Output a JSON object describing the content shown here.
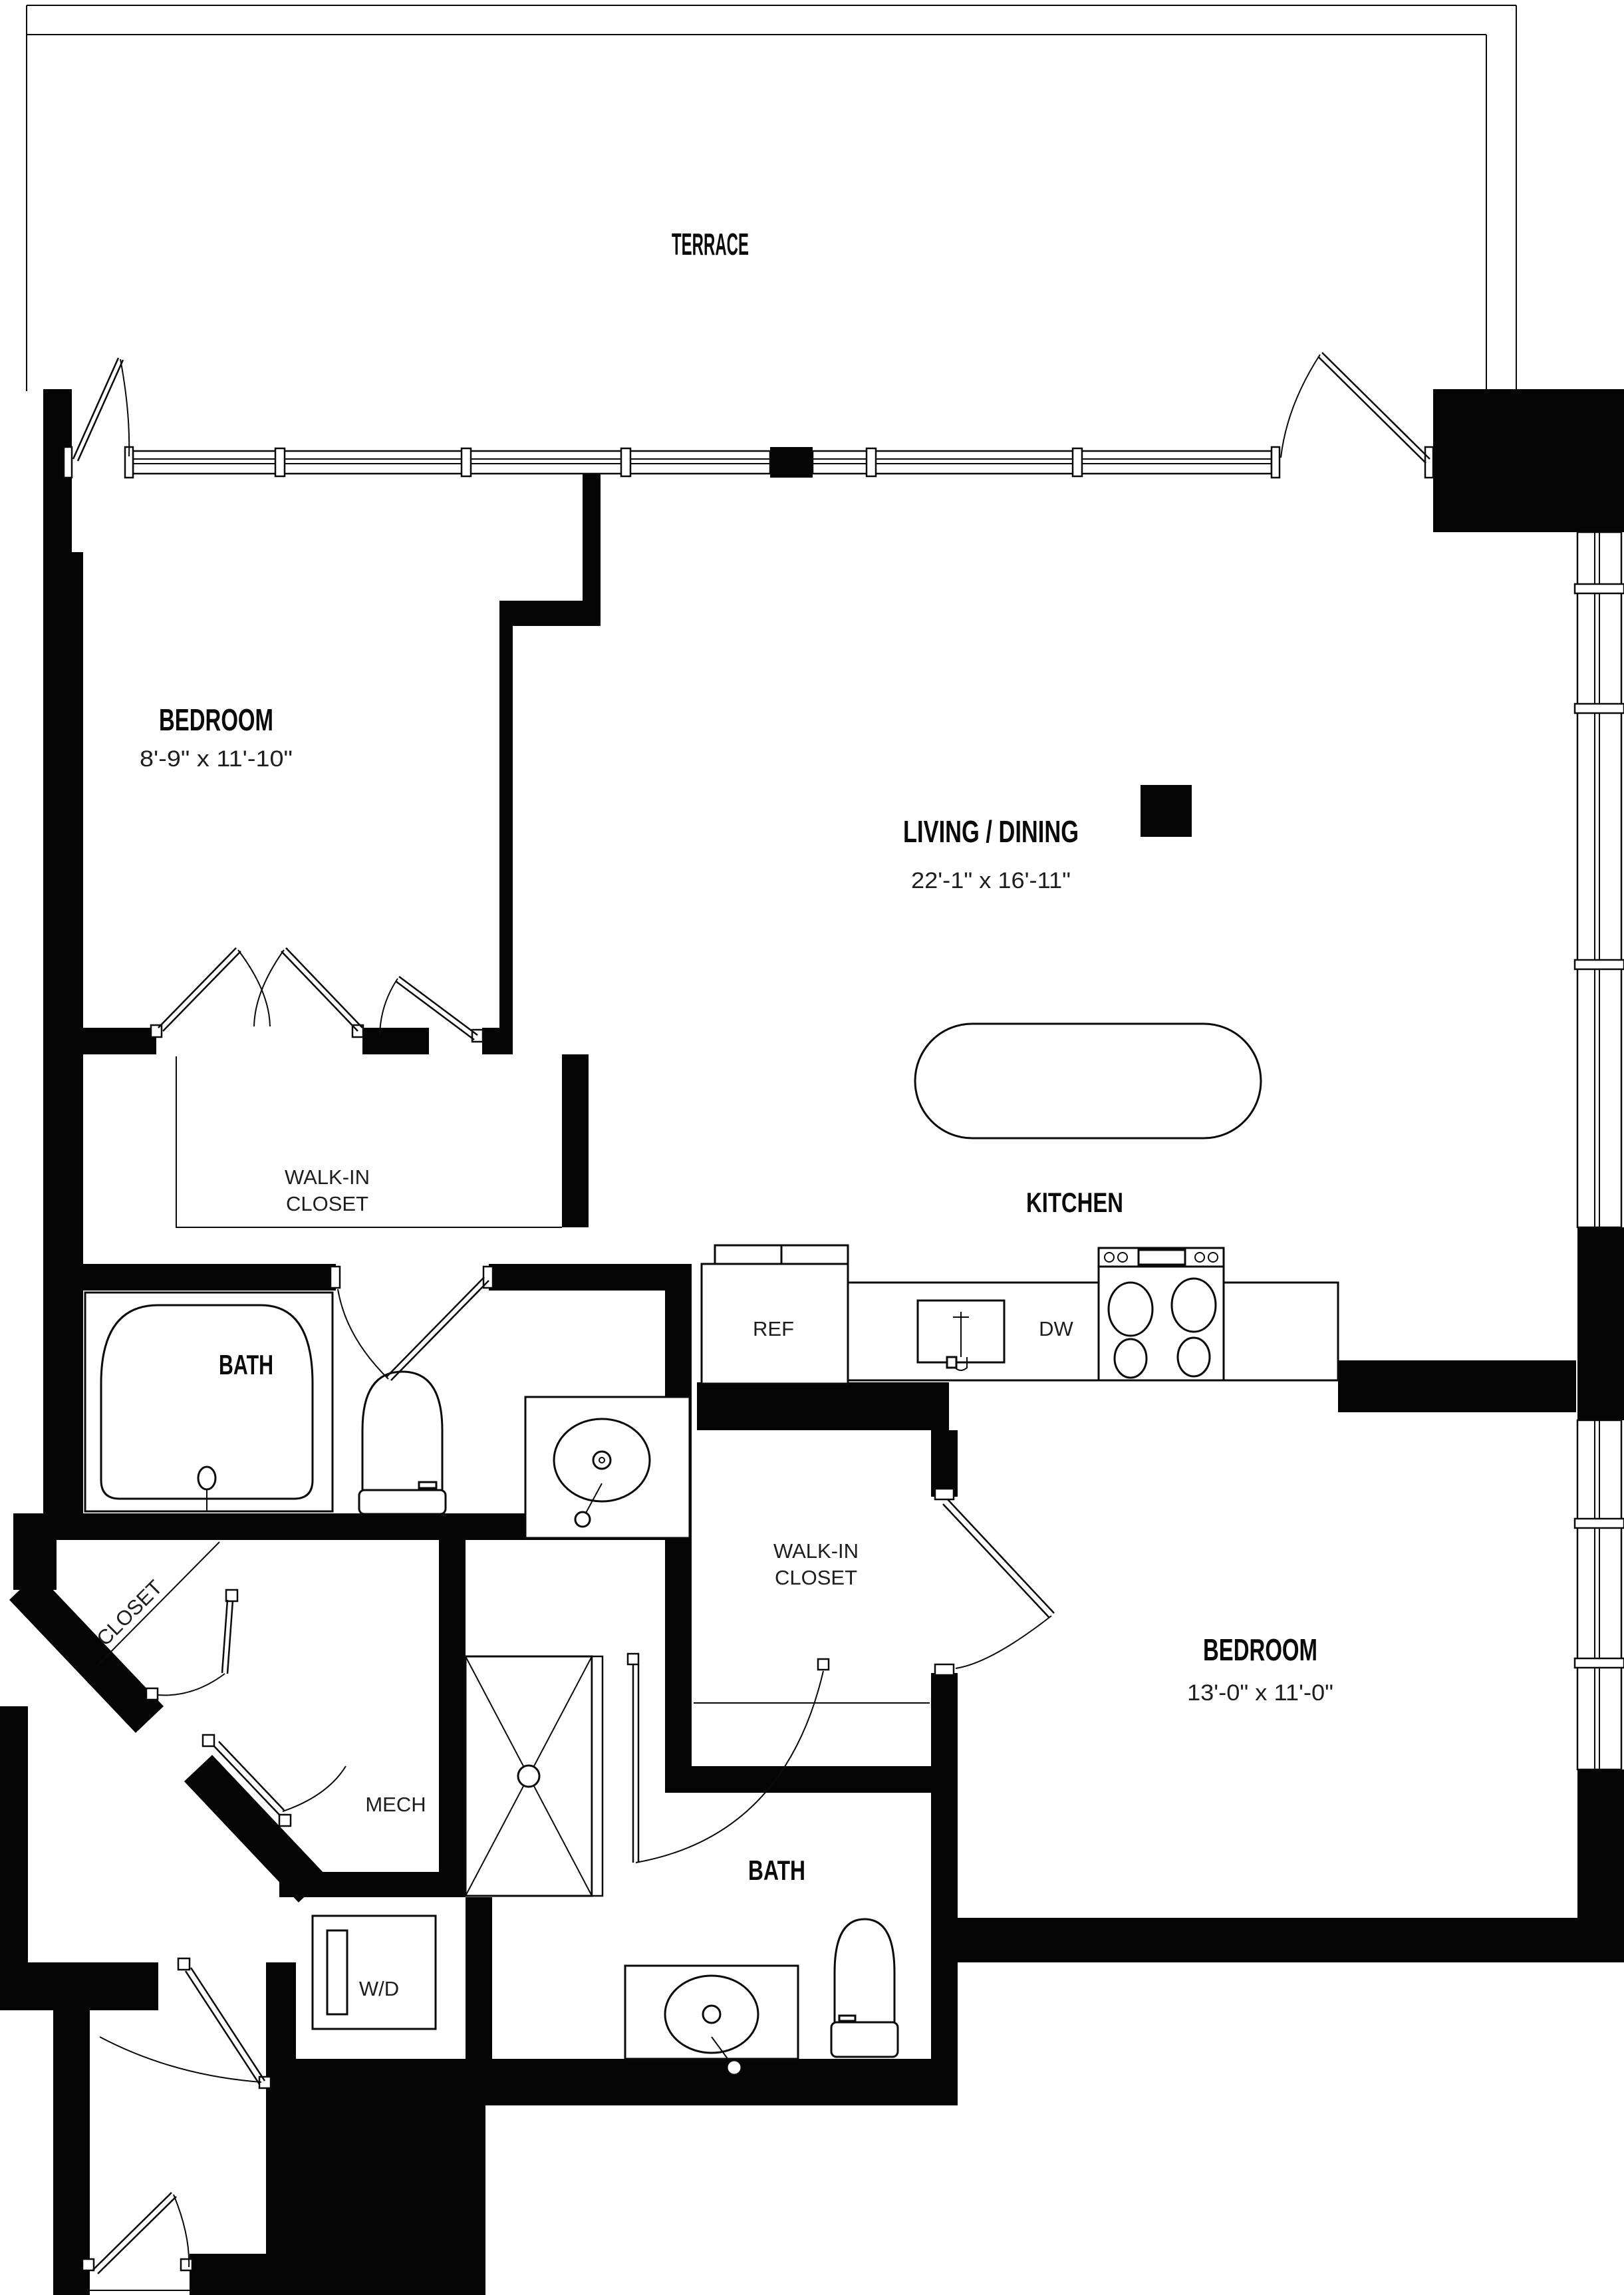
{
  "plan": {
    "type": "apartment-floor-plan",
    "rooms": {
      "terrace": {
        "label": "TERRACE"
      },
      "bedroom1": {
        "label": "BEDROOM",
        "dims": "8'-9\" x 11'-10\""
      },
      "living_dining": {
        "label": "LIVING / DINING",
        "dims": "22'-1\" x 16'-11\""
      },
      "kitchen": {
        "label": "KITCHEN"
      },
      "walk_in_closet_1": {
        "label_line1": "WALK-IN",
        "label_line2": "CLOSET"
      },
      "bath1": {
        "label": "BATH"
      },
      "closet_diagonal": {
        "label": "CLOSET"
      },
      "mech": {
        "label": "MECH"
      },
      "walk_in_closet_2": {
        "label_line1": "WALK-IN",
        "label_line2": "CLOSET"
      },
      "bedroom2": {
        "label": "BEDROOM",
        "dims": "13'-0\" x 11'-0\""
      },
      "bath2": {
        "label": "BATH"
      },
      "laundry": {
        "label": "W/D"
      }
    },
    "appliances": {
      "refrigerator": "REF",
      "dishwasher": "DW"
    },
    "colors": {
      "wall": "#050505",
      "line": "#0a0a0a",
      "background": "#ffffff"
    }
  }
}
